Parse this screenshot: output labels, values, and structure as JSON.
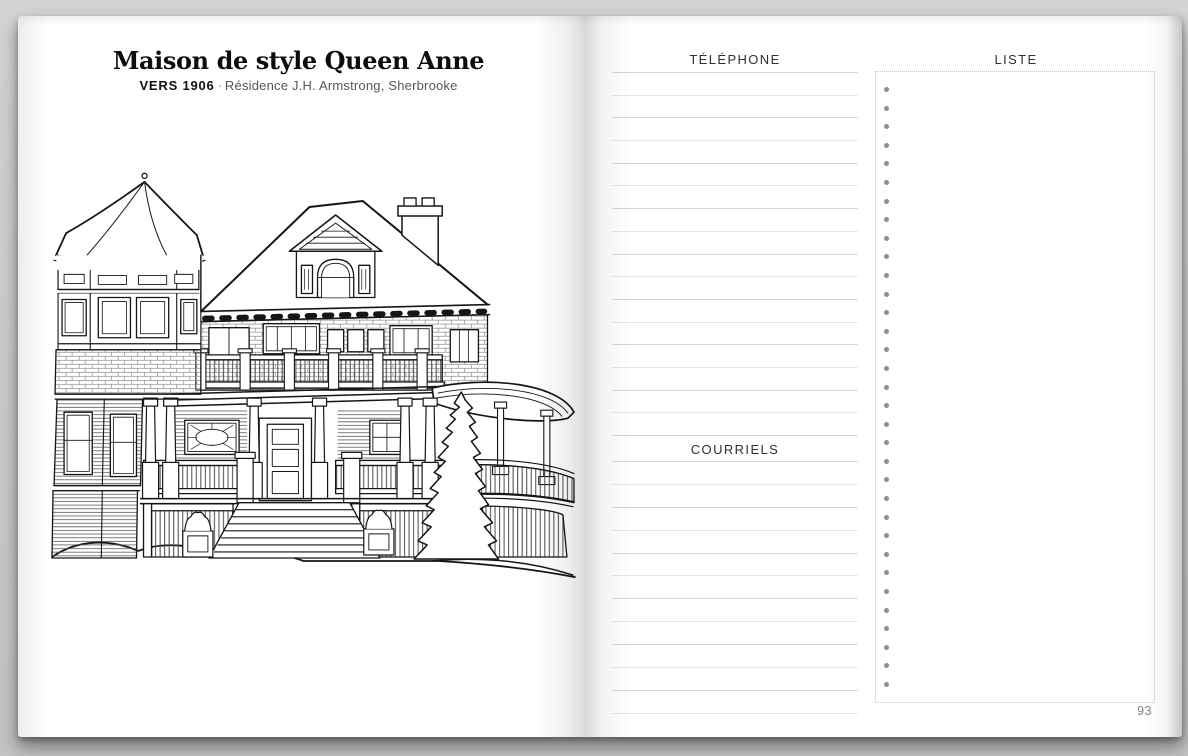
{
  "left_page": {
    "title": "Maison de style Queen Anne",
    "era_label": "VERS 1906",
    "separator": "·",
    "caption": "Résidence J.H. Armstrong, Sherbrooke",
    "illustration": "queen-anne-house-line-drawing"
  },
  "right_page": {
    "sections": {
      "telephone": {
        "label": "TÉLÉPHONE",
        "line_count": 17
      },
      "courriels": {
        "label": "COURRIELS",
        "line_count": 12
      },
      "liste": {
        "label": "LISTE",
        "bullet_count": 33
      }
    },
    "page_number": "93"
  },
  "colors": {
    "background": "#cbcbcb",
    "page": "#ffffff",
    "ink": "#161616",
    "rule_line": "#e0e0e0",
    "list_border": "#c7c7c7",
    "bullet": "#8f8f8f",
    "caption_gray": "#565656",
    "page_number_gray": "#838383"
  }
}
